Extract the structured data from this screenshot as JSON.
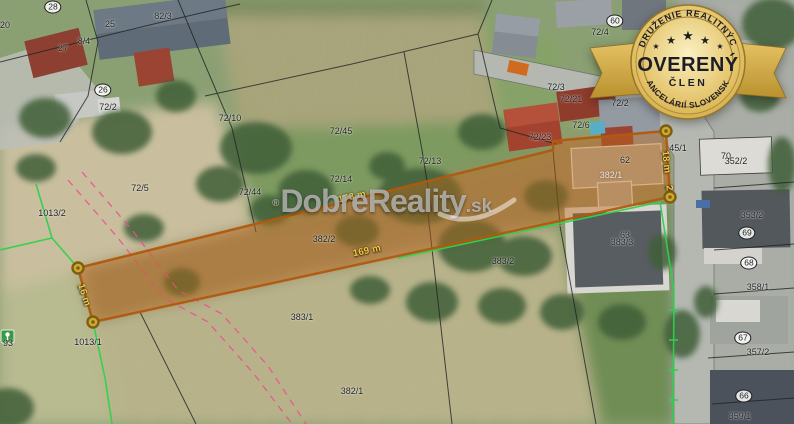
{
  "watermark": {
    "registered": "®",
    "name": "DobreReality",
    "tld": ".sk"
  },
  "badge": {
    "arc_top": "ZDRUŽENIE REALITNÝCH",
    "arc_bottom": "KANCELÁRIÍ SLOVENSKA",
    "title": "OVERENÝ",
    "subtitle": "ČLEN",
    "star": "★"
  },
  "map": {
    "parcel_labels": [
      {
        "text": "82/3",
        "x": 163,
        "y": 16
      },
      {
        "text": "20",
        "x": 5,
        "y": 25
      },
      {
        "text": "25",
        "x": 110,
        "y": 24
      },
      {
        "text": "8/4",
        "x": 84,
        "y": 41
      },
      {
        "text": "27",
        "x": 63,
        "y": 48
      },
      {
        "text": "72/2",
        "x": 108,
        "y": 107
      },
      {
        "text": "72/4",
        "x": 600,
        "y": 32
      },
      {
        "text": "72/3",
        "x": 556,
        "y": 87
      },
      {
        "text": "72/21",
        "x": 571,
        "y": 99
      },
      {
        "text": "72/2",
        "x": 620,
        "y": 103
      },
      {
        "text": "72/6",
        "x": 581,
        "y": 125
      },
      {
        "text": "72/23",
        "x": 540,
        "y": 137
      },
      {
        "text": "62",
        "x": 625,
        "y": 160
      },
      {
        "text": "72/10",
        "x": 230,
        "y": 118
      },
      {
        "text": "72/45",
        "x": 341,
        "y": 131
      },
      {
        "text": "72/13",
        "x": 430,
        "y": 161
      },
      {
        "text": "72/14",
        "x": 341,
        "y": 179
      },
      {
        "text": "72/5",
        "x": 140,
        "y": 188
      },
      {
        "text": "72/44",
        "x": 250,
        "y": 192
      },
      {
        "text": "1013/2",
        "x": 52,
        "y": 213
      },
      {
        "text": "382/2",
        "x": 324,
        "y": 239
      },
      {
        "text": "383/2",
        "x": 503,
        "y": 261
      },
      {
        "text": "382/1",
        "x": 611,
        "y": 175,
        "c": "w"
      },
      {
        "text": "383/1",
        "x": 302,
        "y": 317
      },
      {
        "text": "382/1",
        "x": 352,
        "y": 391
      },
      {
        "text": "1013/1",
        "x": 88,
        "y": 342
      },
      {
        "text": "93",
        "x": 8,
        "y": 343
      },
      {
        "text": "63",
        "x": 625,
        "y": 235
      },
      {
        "text": "383/3",
        "x": 622,
        "y": 242
      },
      {
        "text": "45/1",
        "x": 678,
        "y": 148
      },
      {
        "text": "70",
        "x": 726,
        "y": 156
      },
      {
        "text": "352/2",
        "x": 736,
        "y": 161
      },
      {
        "text": "353/2",
        "x": 752,
        "y": 215
      },
      {
        "text": "358/1",
        "x": 758,
        "y": 287
      },
      {
        "text": "357/2",
        "x": 758,
        "y": 352
      },
      {
        "text": "359/1",
        "x": 740,
        "y": 416
      }
    ],
    "house_numbers": [
      {
        "text": "28",
        "x": 53,
        "y": 7
      },
      {
        "text": "26",
        "x": 103,
        "y": 90
      },
      {
        "text": "60",
        "x": 615,
        "y": 21
      },
      {
        "text": "69",
        "x": 747,
        "y": 233
      },
      {
        "text": "68",
        "x": 749,
        "y": 263
      },
      {
        "text": "67",
        "x": 743,
        "y": 338
      },
      {
        "text": "66",
        "x": 744,
        "y": 396
      }
    ],
    "measurements": [
      {
        "text": "173 m",
        "x": 352,
        "y": 197,
        "rot": -13
      },
      {
        "text": "169 m",
        "x": 367,
        "y": 251,
        "rot": -12
      },
      {
        "text": "16 m",
        "x": 84,
        "y": 295,
        "rot": 72
      },
      {
        "text": "18 m",
        "x": 666,
        "y": 162,
        "rot": 84
      },
      {
        "text": "2",
        "x": 669,
        "y": 188,
        "rot": 84
      }
    ]
  },
  "colors": {
    "parcel_highlight": "#b35c10",
    "boundary_green": "#2fd14f",
    "utility_line_pink": "#ef4f92",
    "measurement_yellow": "#f2cd3e",
    "badge_gold": "#d4a93c",
    "badge_text": "#1c1d26"
  }
}
